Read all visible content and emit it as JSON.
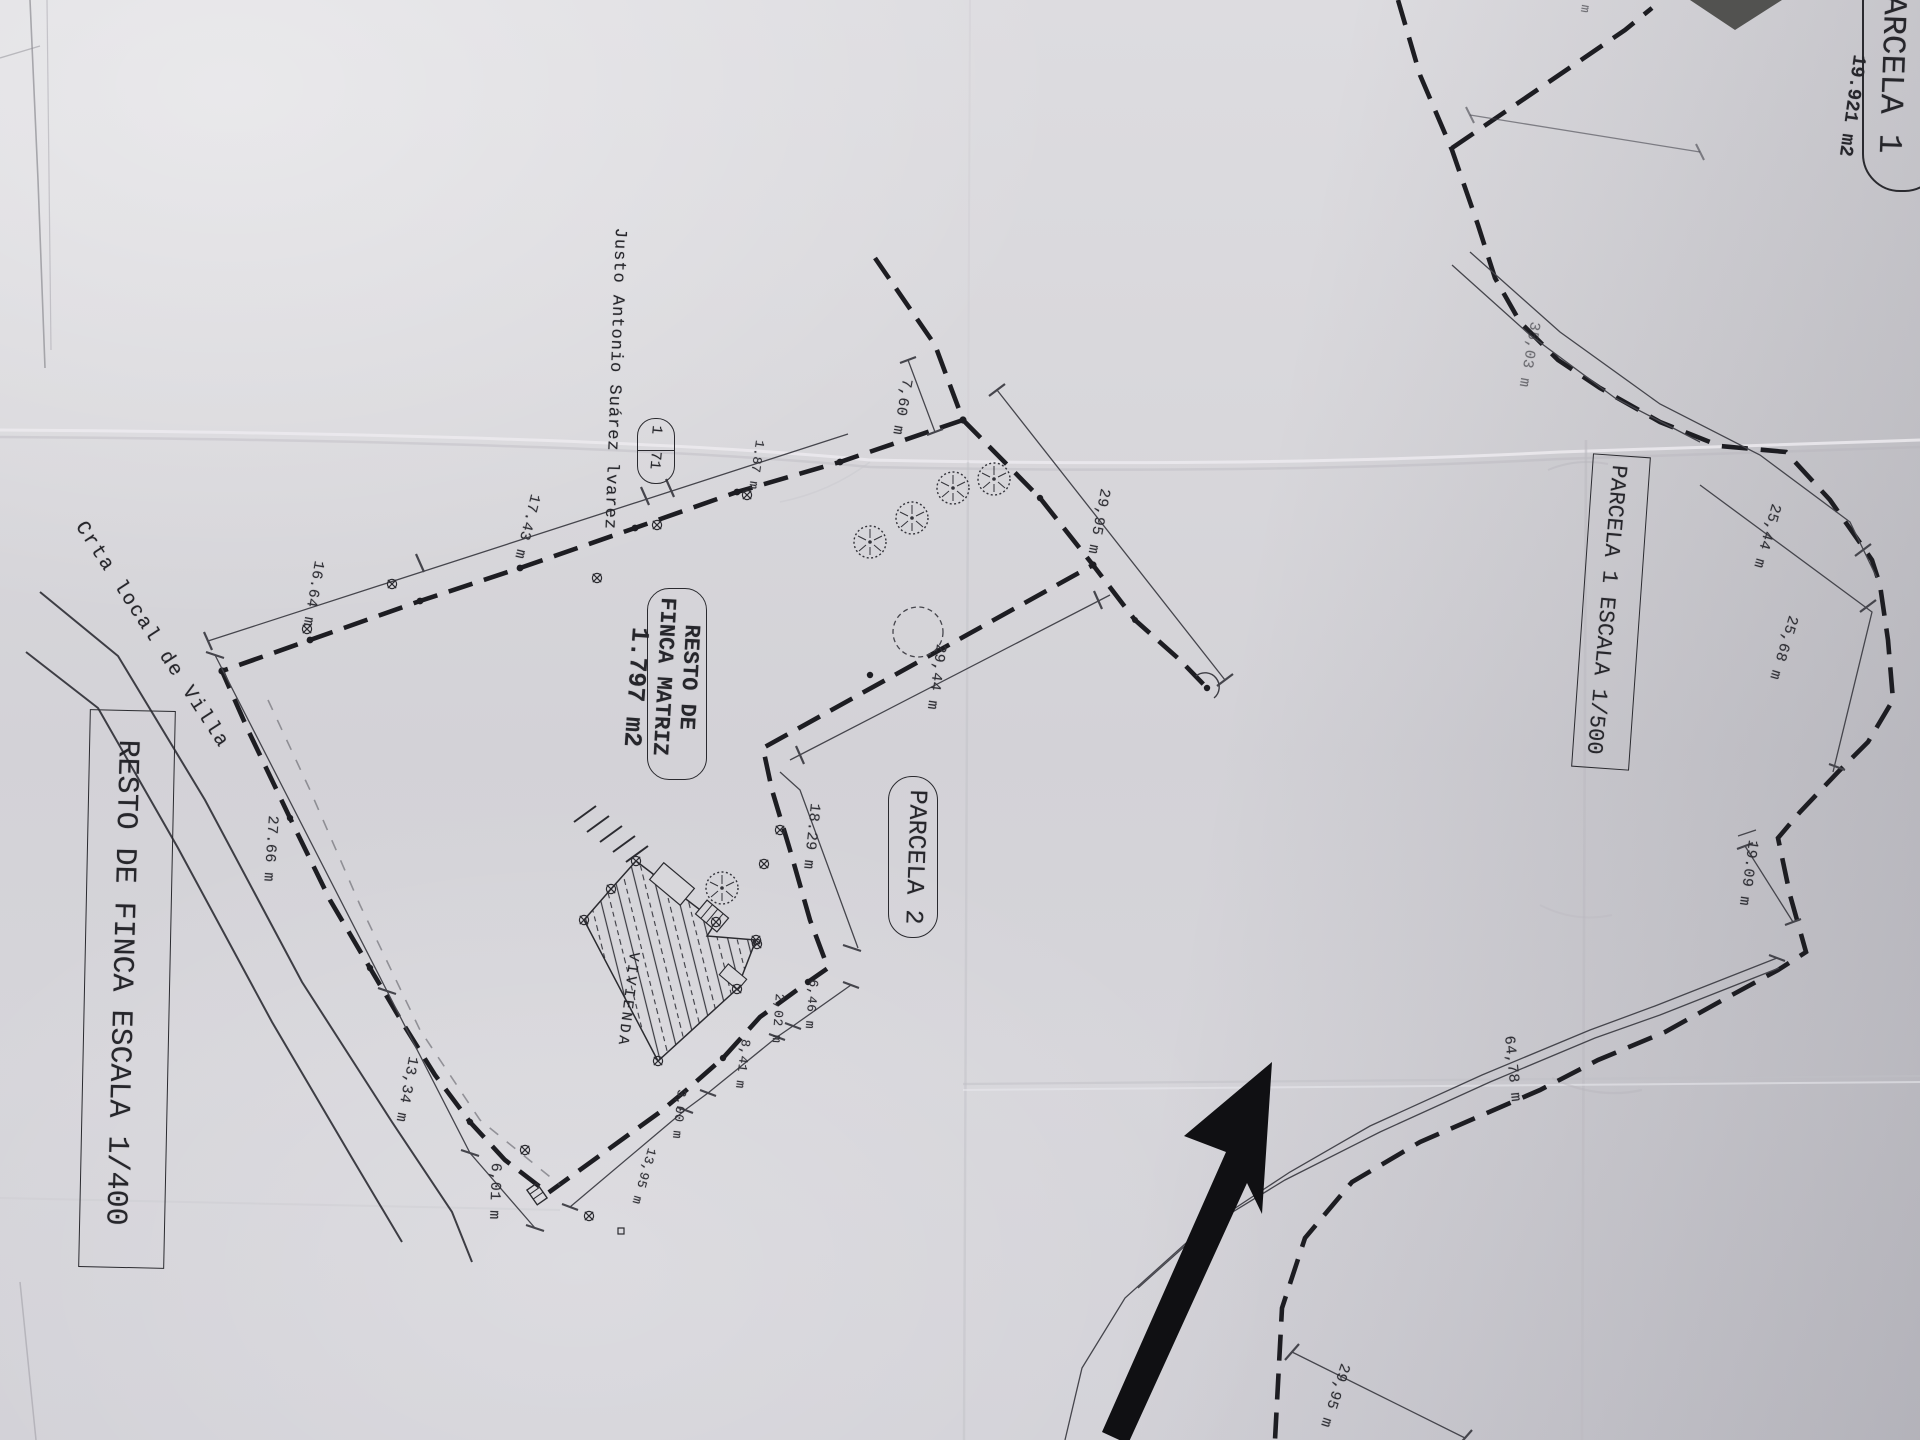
{
  "left_plan": {
    "title": "RESTO DE FINCA ESCALA 1/400",
    "road_label": "Crta local de Villa",
    "owner_label": "Justo Antonio Suárez lvarez",
    "parcel_ref": {
      "top": "1",
      "bottom": "71"
    },
    "resto_box": {
      "line1": "RESTO DE",
      "line2": "FINCA MATRIZ"
    },
    "resto_area": "1.797 m2",
    "parcela2_label": "PARCELA 2",
    "house_label": "VIVIENDA",
    "dims": {
      "top_apex": "7,60 m",
      "ne": "29,95 m",
      "p2_west": "29,44 m",
      "p2_sw": "18.29 m",
      "nw1": "1.87 m",
      "nw2": "17.43 m",
      "nw3": "16.64 m",
      "road1": "27.66 m",
      "road2": "13,34 m",
      "road3": "6,01 m",
      "s1": "6,46 m",
      "s2": "2,02 m",
      "s3": "8,41 m",
      "s4": "3,00 m",
      "s5": "13,95 m"
    }
  },
  "right_plan": {
    "title": "PARCELA 1 ESCALA 1/500",
    "parcel_badge": "PARCELA 1",
    "area": "19.921 m2",
    "cut_unit": "m",
    "dims": {
      "n": "35,03 m",
      "e1": "25,44 m",
      "e2": "25,68 m",
      "e3": "19.09 m",
      "s": "64,78 m",
      "sw": "29,95 m"
    }
  }
}
